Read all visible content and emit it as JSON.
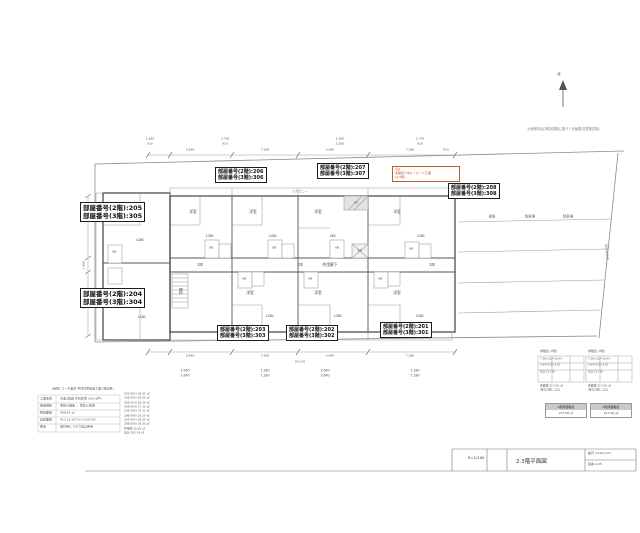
{
  "north": {
    "label": "北"
  },
  "notes": {
    "top_right": "土地資料及び現況調査に基づく計画図(意匠検討用)"
  },
  "highlight": {
    "lines": [
      "(注)",
      "太陽光パネル・ルーフ工事",
      "(2,3階)"
    ]
  },
  "room_boxes": [
    {
      "id": "206",
      "line1": "部屋番号(2階):206",
      "line2": "部屋番号(3階):306"
    },
    {
      "id": "207",
      "line1": "部屋番号(2階):207",
      "line2": "部屋番号(3階):307"
    },
    {
      "id": "208",
      "line1": "部屋番号(2階):208",
      "line2": "部屋番号(3階):308"
    },
    {
      "id": "205",
      "line1": "部屋番号(2階):205",
      "line2": "部屋番号(3階):305"
    },
    {
      "id": "204",
      "line1": "部屋番号(2階):204",
      "line2": "部屋番号(3階):304"
    },
    {
      "id": "203",
      "line1": "部屋番号(2階):203",
      "line2": "部屋番号(3階):303"
    },
    {
      "id": "202",
      "line1": "部屋番号(2階):202",
      "line2": "部屋番号(3階):302"
    },
    {
      "id": "201",
      "line1": "部屋番号(2階):201",
      "line2": "部屋番号(3階):301"
    }
  ],
  "legend": {
    "tables": [
      {
        "title": "求積表 (2階)"
      },
      {
        "title": "求積表 (3階)"
      }
    ],
    "boxes": [
      {
        "header": "2階床面積表",
        "value": "217.00 ㎡"
      },
      {
        "header": "3階床面積表",
        "value": "217.00 ㎡"
      }
    ]
  },
  "title_block": {
    "scale": "S=1/100",
    "title": "2.3階平面図",
    "right_line1": "縮尺 1/100 (A3)",
    "right_line2": "図番 A-05"
  },
  "annotations": [
    {
      "t": "洋室",
      "x": 120,
      "y": 212
    },
    {
      "t": "LDK",
      "x": 140,
      "y": 240
    },
    {
      "t": "UB",
      "x": 114,
      "y": 252,
      "s": 3
    },
    {
      "t": "洋室",
      "x": 193,
      "y": 212
    },
    {
      "t": "LDK",
      "x": 210,
      "y": 236
    },
    {
      "t": "UB",
      "x": 211,
      "y": 248,
      "s": 3
    },
    {
      "t": "洋室",
      "x": 253,
      "y": 212
    },
    {
      "t": "LDK",
      "x": 273,
      "y": 236
    },
    {
      "t": "UB",
      "x": 274,
      "y": 248,
      "s": 3
    },
    {
      "t": "洋室",
      "x": 318,
      "y": 212
    },
    {
      "t": "DK",
      "x": 333,
      "y": 236
    },
    {
      "t": "UB",
      "x": 337,
      "y": 248,
      "s": 3
    },
    {
      "t": "洋室",
      "x": 397,
      "y": 212
    },
    {
      "t": "LDK",
      "x": 421,
      "y": 236
    },
    {
      "t": "UB",
      "x": 411,
      "y": 249,
      "s": 3
    },
    {
      "t": "洋室",
      "x": 121,
      "y": 291
    },
    {
      "t": "LDK",
      "x": 142,
      "y": 317
    },
    {
      "t": "洋室",
      "x": 250,
      "y": 293
    },
    {
      "t": "LDK",
      "x": 270,
      "y": 316
    },
    {
      "t": "UB",
      "x": 244,
      "y": 279,
      "s": 3
    },
    {
      "t": "洋室",
      "x": 318,
      "y": 293
    },
    {
      "t": "LDK",
      "x": 338,
      "y": 316
    },
    {
      "t": "UB",
      "x": 310,
      "y": 279,
      "s": 3
    },
    {
      "t": "洋室",
      "x": 397,
      "y": 293
    },
    {
      "t": "LDK",
      "x": 420,
      "y": 316
    },
    {
      "t": "UB",
      "x": 380,
      "y": 279,
      "s": 3
    },
    {
      "t": "共用廊下",
      "x": 330,
      "y": 265,
      "s": 3.8
    },
    {
      "t": "EV",
      "x": 360,
      "y": 251,
      "s": 3.2
    },
    {
      "t": "階段",
      "x": 180,
      "y": 291,
      "s": 3.2,
      "r": 90
    },
    {
      "t": "PS",
      "x": 356,
      "y": 203,
      "s": 2.8
    },
    {
      "t": "玄関",
      "x": 200,
      "y": 265,
      "s": 2.8
    },
    {
      "t": "玄関",
      "x": 300,
      "y": 265,
      "s": 2.8
    },
    {
      "t": "玄関",
      "x": 432,
      "y": 265,
      "s": 2.8
    },
    {
      "t": "バルコニー",
      "x": 300,
      "y": 192,
      "s": 3.2,
      "c": "#777"
    },
    {
      "t": "バルコニー",
      "x": 300,
      "y": 336,
      "s": 3.2,
      "c": "#777"
    },
    {
      "t": "車路",
      "x": 492,
      "y": 217,
      "s": 3.4,
      "c": "#666"
    },
    {
      "t": "駐車場",
      "x": 530,
      "y": 217,
      "s": 3.4,
      "c": "#666"
    },
    {
      "t": "駐車場",
      "x": 568,
      "y": 217,
      "s": 3.4,
      "c": "#666"
    },
    {
      "t": "隣地境界線",
      "x": 606,
      "y": 252,
      "s": 3.2,
      "c": "#888",
      "r": 84
    },
    {
      "t": "3,640",
      "x": 190,
      "y": 150,
      "s": 3,
      "c": "#555"
    },
    {
      "t": "7,280",
      "x": 265,
      "y": 150,
      "s": 3,
      "c": "#555"
    },
    {
      "t": "3,640",
      "x": 330,
      "y": 150,
      "s": 3,
      "c": "#555"
    },
    {
      "t": "7,280",
      "x": 410,
      "y": 150,
      "s": 3,
      "c": "#555"
    },
    {
      "t": "910",
      "x": 446,
      "y": 150,
      "s": 3,
      "c": "#555"
    },
    {
      "t": "1,820",
      "x": 150,
      "y": 139,
      "s": 3,
      "c": "#555"
    },
    {
      "t": "910",
      "x": 150,
      "y": 144,
      "s": 3,
      "c": "#555"
    },
    {
      "t": "2,730",
      "x": 225,
      "y": 139,
      "s": 3,
      "c": "#555"
    },
    {
      "t": "910",
      "x": 225,
      "y": 144,
      "s": 3,
      "c": "#555"
    },
    {
      "t": "1,820",
      "x": 340,
      "y": 139,
      "s": 3,
      "c": "#555"
    },
    {
      "t": "1,820",
      "x": 340,
      "y": 144,
      "s": 3,
      "c": "#555"
    },
    {
      "t": "2,730",
      "x": 420,
      "y": 139,
      "s": 3,
      "c": "#555"
    },
    {
      "t": "910",
      "x": 420,
      "y": 144,
      "s": 3,
      "c": "#555"
    },
    {
      "t": "3,185",
      "x": 84,
      "y": 216,
      "s": 3,
      "c": "#555",
      "r": -90
    },
    {
      "t": "1,820",
      "x": 84,
      "y": 265,
      "s": 3,
      "c": "#555",
      "r": -90
    },
    {
      "t": "3,185",
      "x": 84,
      "y": 305,
      "s": 3,
      "c": "#555",
      "r": -90
    },
    {
      "t": "3,640",
      "x": 190,
      "y": 356,
      "s": 3,
      "c": "#555"
    },
    {
      "t": "7,280",
      "x": 265,
      "y": 356,
      "s": 3,
      "c": "#555"
    },
    {
      "t": "3,640",
      "x": 330,
      "y": 356,
      "s": 3,
      "c": "#555"
    },
    {
      "t": "7,280",
      "x": 410,
      "y": 356,
      "s": 3,
      "c": "#555"
    },
    {
      "t": "29,120",
      "x": 300,
      "y": 362,
      "s": 3,
      "c": "#555"
    },
    {
      "t": "3,640",
      "x": 185,
      "y": 371,
      "s": 3.2,
      "c": "#555"
    },
    {
      "t": "3,640",
      "x": 185,
      "y": 376,
      "s": 3.2,
      "c": "#555"
    },
    {
      "t": "7,280",
      "x": 265,
      "y": 371,
      "s": 3.2,
      "c": "#555"
    },
    {
      "t": "7,280",
      "x": 265,
      "y": 376,
      "s": 3.2,
      "c": "#555"
    },
    {
      "t": "3,640",
      "x": 325,
      "y": 371,
      "s": 3.2,
      "c": "#555"
    },
    {
      "t": "3,640",
      "x": 325,
      "y": 376,
      "s": 3.2,
      "c": "#555"
    },
    {
      "t": "7,280",
      "x": 415,
      "y": 371,
      "s": 3.2,
      "c": "#555"
    },
    {
      "t": "7,280",
      "x": 415,
      "y": 376,
      "s": 3.2,
      "c": "#555"
    },
    {
      "t": "(仮称) コーポ金沢 共同住宅新築工事 (検討用)",
      "x": 52,
      "y": 389,
      "s": 3,
      "c": "#555",
      "l": 1
    },
    {
      "t": "工事名称",
      "x": 40,
      "y": 399,
      "s": 3,
      "c": "#555",
      "l": 1
    },
    {
      "t": "木造2階建 共同住宅 (1R×8戸)",
      "x": 60,
      "y": 399,
      "s": 3,
      "c": "#555",
      "l": 1
    },
    {
      "t": "構造規模",
      "x": 40,
      "y": 406,
      "s": 3,
      "c": "#555",
      "l": 1
    },
    {
      "t": "準耐火構造 ・ 準防火地域",
      "x": 60,
      "y": 406,
      "s": 3,
      "c": "#555",
      "l": 1
    },
    {
      "t": "敷地面積",
      "x": 40,
      "y": 413,
      "s": 3,
      "c": "#555",
      "l": 1
    },
    {
      "t": "998.45 ㎡",
      "x": 60,
      "y": 413,
      "s": 3,
      "c": "#555",
      "l": 1
    },
    {
      "t": "延床面積",
      "x": 40,
      "y": 420,
      "s": 3,
      "c": "#555",
      "l": 1
    },
    {
      "t": "412.16 ㎡ (S=1:100 A3)",
      "x": 60,
      "y": 420,
      "s": 3,
      "c": "#555",
      "l": 1
    },
    {
      "t": "備考",
      "x": 40,
      "y": 427,
      "s": 3,
      "c": "#555",
      "l": 1
    },
    {
      "t": "検討用につき寸法は参考",
      "x": 60,
      "y": 427,
      "s": 3,
      "c": "#555",
      "l": 1
    },
    {
      "t": "201(301)  28.35 ㎡",
      "x": 124,
      "y": 394,
      "s": 2.8,
      "c": "#555",
      "l": 1
    },
    {
      "t": "202(302)  26.50 ㎡",
      "x": 124,
      "y": 398,
      "s": 2.8,
      "c": "#555",
      "l": 1
    },
    {
      "t": "203(303)  26.50 ㎡",
      "x": 124,
      "y": 403,
      "s": 2.8,
      "c": "#555",
      "l": 1
    },
    {
      "t": "204(304)  27.12 ㎡",
      "x": 124,
      "y": 407,
      "s": 2.8,
      "c": "#555",
      "l": 1
    },
    {
      "t": "205(305)  27.12 ㎡",
      "x": 124,
      "y": 411,
      "s": 2.8,
      "c": "#555",
      "l": 1
    },
    {
      "t": "206(306)  26.50 ㎡",
      "x": 124,
      "y": 416,
      "s": 2.8,
      "c": "#555",
      "l": 1
    },
    {
      "t": "207(307)  26.50 ㎡",
      "x": 124,
      "y": 420,
      "s": 2.8,
      "c": "#555",
      "l": 1
    },
    {
      "t": "208(308)  28.35 ㎡",
      "x": 124,
      "y": 424,
      "s": 2.8,
      "c": "#555",
      "l": 1
    },
    {
      "t": "共用部   18.20 ㎡",
      "x": 124,
      "y": 429,
      "s": 2.8,
      "c": "#555",
      "l": 1
    },
    {
      "t": "合計    235.14 ㎡",
      "x": 124,
      "y": 433,
      "s": 2.8,
      "c": "#555",
      "l": 1
    },
    {
      "t": "7.28×3.64  26.49",
      "x": 540,
      "y": 360,
      "s": 2.6,
      "c": "#556",
      "l": 1
    },
    {
      "t": "3.64×1.82   6.62",
      "x": 540,
      "y": 366,
      "s": 2.6,
      "c": "#556",
      "l": 1
    },
    {
      "t": "合計   217.00",
      "x": 540,
      "y": 373,
      "s": 2.6,
      "c": "#556",
      "l": 1
    },
    {
      "t": "7.28×3.64  26.49",
      "x": 588,
      "y": 360,
      "s": 2.6,
      "c": "#556",
      "l": 1
    },
    {
      "t": "3.64×1.82   6.62",
      "x": 588,
      "y": 366,
      "s": 2.6,
      "c": "#556",
      "l": 1
    },
    {
      "t": "合計   217.00",
      "x": 588,
      "y": 373,
      "s": 2.6,
      "c": "#556",
      "l": 1
    },
    {
      "t": "床面積 217.00 ㎡",
      "x": 540,
      "y": 386,
      "s": 2.8,
      "c": "#556",
      "l": 1
    },
    {
      "t": "(壁芯計算による)",
      "x": 540,
      "y": 391,
      "s": 2.6,
      "c": "#556",
      "l": 1
    },
    {
      "t": "床面積 217.00 ㎡",
      "x": 588,
      "y": 386,
      "s": 2.8,
      "c": "#556",
      "l": 1
    },
    {
      "t": "(壁芯計算による)",
      "x": 588,
      "y": 391,
      "s": 2.6,
      "c": "#556",
      "l": 1
    }
  ]
}
